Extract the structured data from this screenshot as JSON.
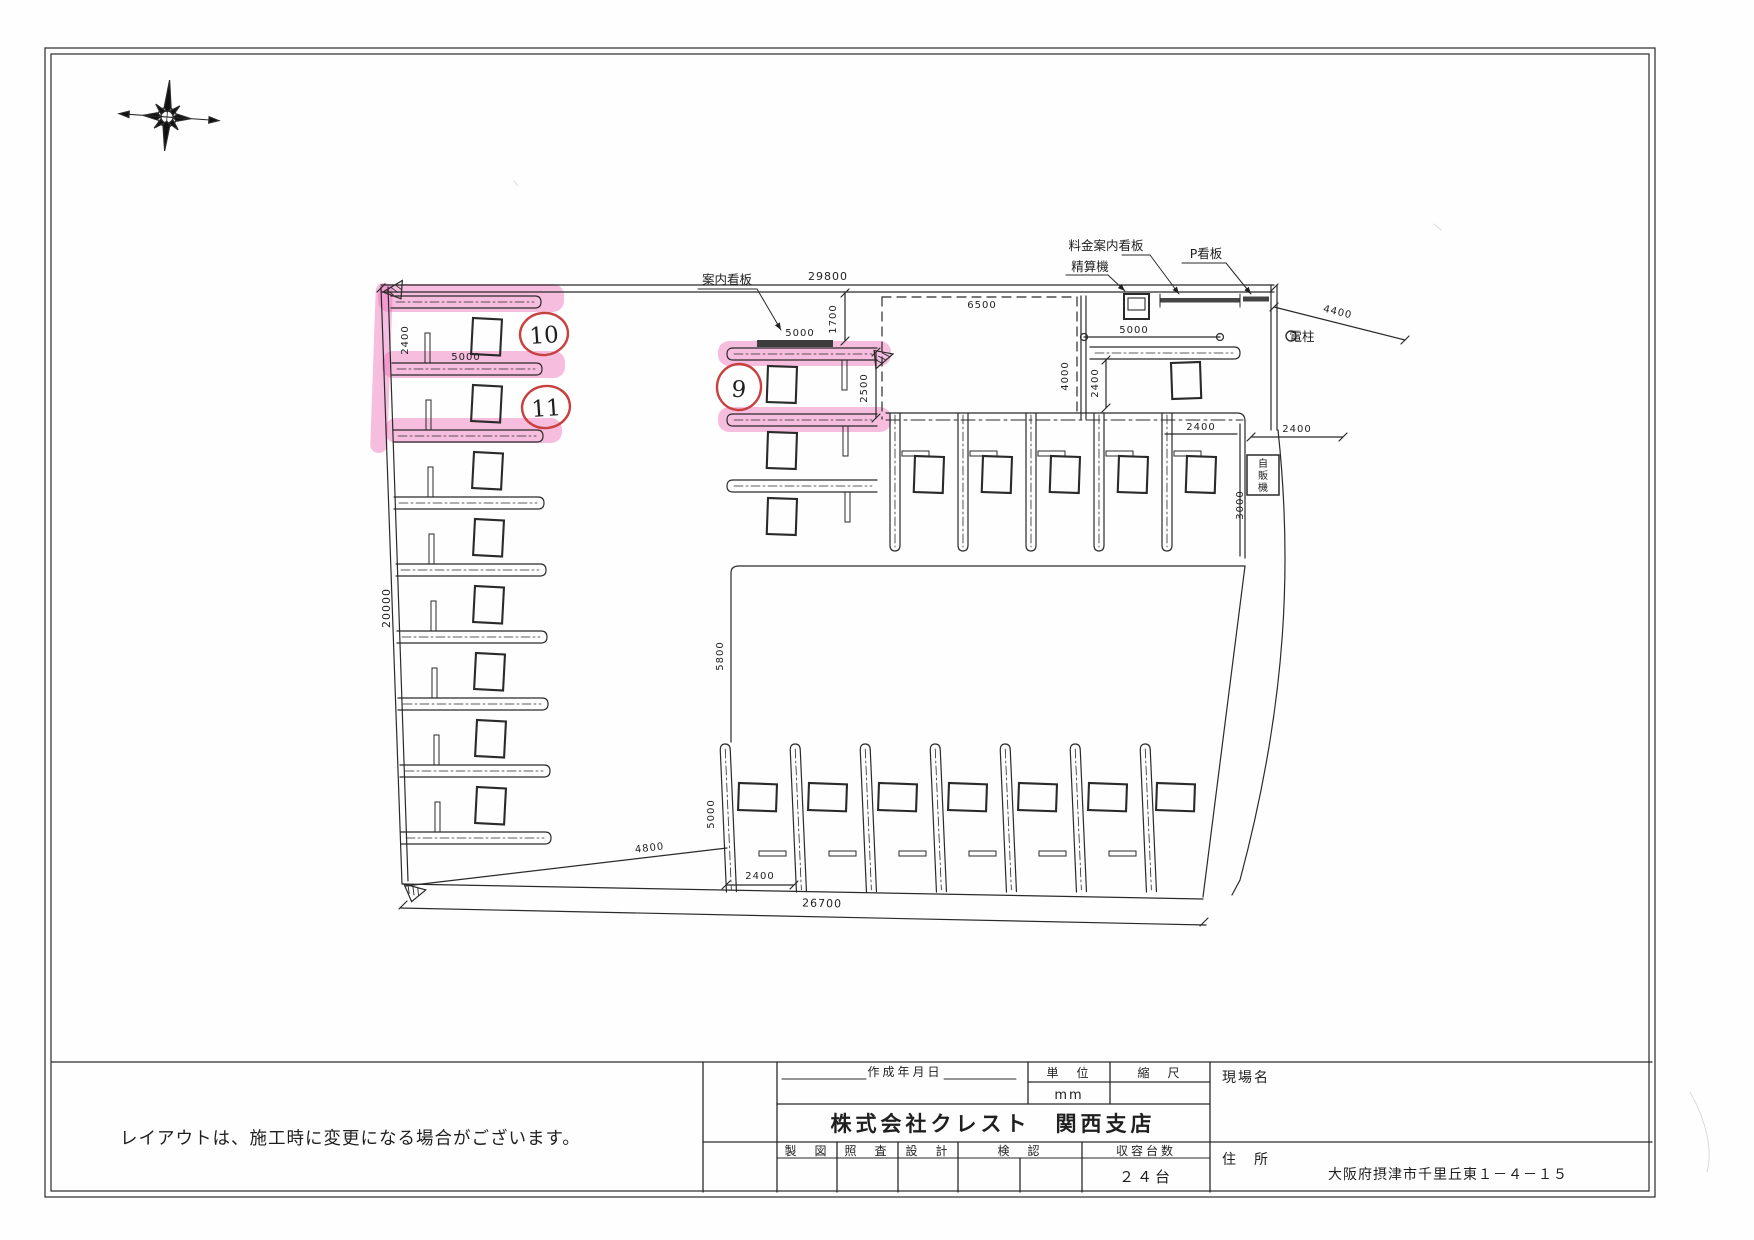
{
  "page": {
    "background": "#ffffff",
    "border_color": "#2a2a2a"
  },
  "plan": {
    "labels": {
      "guide_sign": "案内看板",
      "fee_sign": "料金案内看板",
      "pay_machine": "精算機",
      "p_sign": "P看板",
      "pole": "電柱",
      "vending_chars": [
        "自",
        "販",
        "機"
      ]
    },
    "dims": {
      "site_top": "29800",
      "site_left": "20000",
      "site_bottom": "26700",
      "stall_width": "2400",
      "stall_length": "5000",
      "sign_offset": "1700",
      "sign_length": "5000",
      "entrance_width": "6500",
      "entrance_depth": "4000",
      "bay_depth": "2500",
      "gate_length": "5000",
      "road_offset": "4400",
      "mid_aisle": "5800",
      "bottom_aisle": "4800",
      "vending_offset": "3000"
    },
    "highlights": {
      "nine": "9",
      "ten": "10",
      "eleven": "11",
      "marker_color": "#ee6eb9",
      "circle_color": "#c94040"
    }
  },
  "note": {
    "text": "レイアウトは、施工時に変更になる場合がございます。"
  },
  "title_block": {
    "created_date_label": "作成年月日",
    "unit_label": "単　位",
    "unit_value": "mm",
    "scale_label": "縮　尺",
    "company": "株式会社クレスト　関西支店",
    "drafting_label": "製　図",
    "review_label": "照　査",
    "design_label": "設　計",
    "verify_label": "検　認",
    "capacity_label": "収容台数",
    "capacity_value": "２４台",
    "site_name_label": "現場名",
    "address_label": "住　所",
    "address_value": "大阪府摂津市千里丘東１－４－１５"
  }
}
